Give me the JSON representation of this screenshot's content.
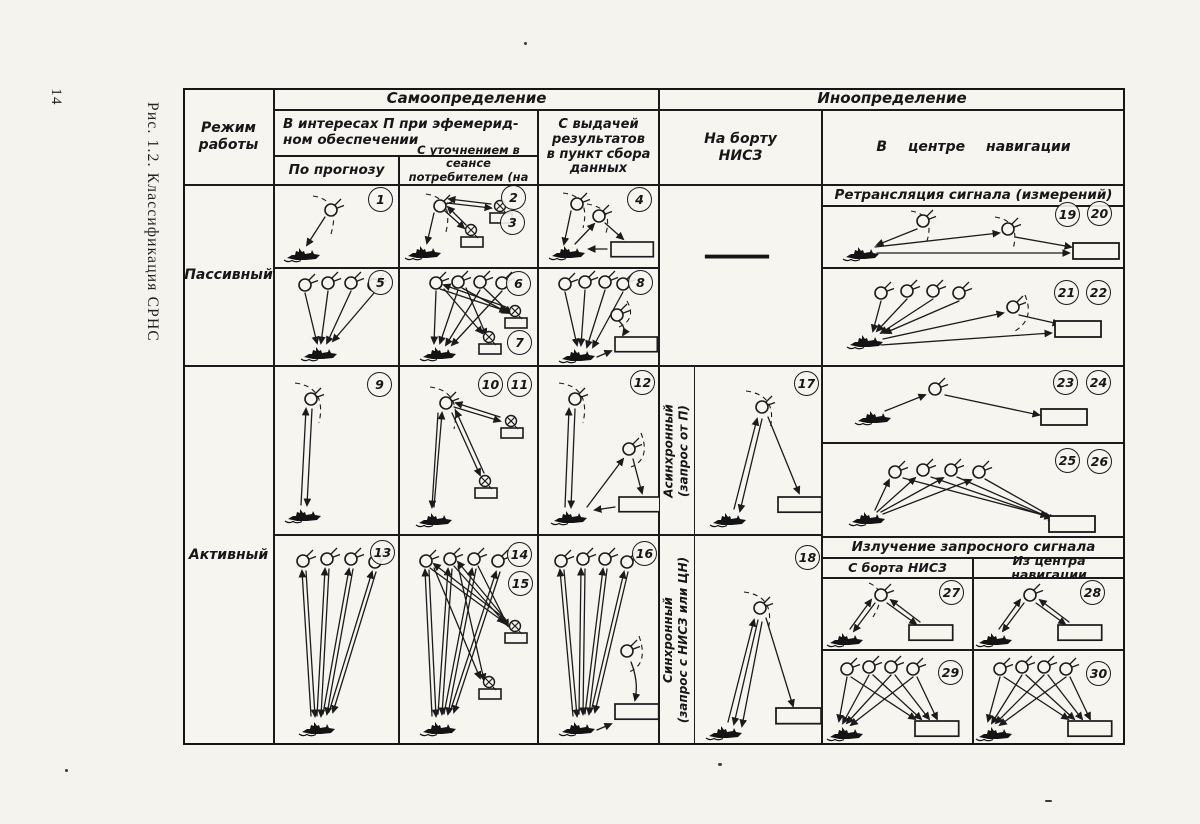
{
  "page": {
    "number": "14",
    "caption": "Рис. 1.2. Классификация СРНС"
  },
  "table": {
    "regime1": "Режим",
    "regime2": "работы",
    "self": "Самоопределение",
    "other": "Иноопределение",
    "interests1": "В интересах П при эфемерид-",
    "interests2": "ном обеспечении",
    "forecast": "По прогнозу",
    "refine1": "С уточнением в сеансе",
    "refine2": "потребителем (на НИСЗ)",
    "results1": "С выдачей",
    "results2": "результатов",
    "results3": "в пункт сбора",
    "results4": "данных",
    "onboard1": "На борту",
    "onboard2": "НИСЗ",
    "center": "В центре  навигации",
    "relay": "Ретрансляция сигнала (измерений)",
    "emission": "Излучение запросного сигнала",
    "from_board": "С борта НИСЗ",
    "from_center": "Из центра навигации",
    "passive": "Пассивный",
    "active": "Активный",
    "async1": "Асинхронный",
    "async2": "(запрос от П)",
    "sync1": "Синхронный",
    "sync2": "(запрос с НИСЗ или ЦН)",
    "dash": "—",
    "badges": {
      "n1": "1",
      "n2": "2",
      "n3": "3",
      "n4": "4",
      "n5": "5",
      "n6": "6",
      "n7": "7",
      "n8": "8",
      "n9": "9",
      "n10": "10",
      "n11": "11",
      "n12": "12",
      "n13": "13",
      "n14": "14",
      "n15": "15",
      "n16": "16",
      "n17": "17",
      "n18": "18",
      "n19": "19",
      "n20": "20",
      "n21": "21",
      "n22": "22",
      "n23": "23",
      "n24": "24",
      "n25": "25",
      "n26": "26",
      "n27": "27",
      "n28": "28",
      "n29": "29",
      "n30": "30"
    }
  },
  "icons": {
    "satellite": "satellite-icon",
    "ship": "ship-icon",
    "ground_station": "ground-station-icon",
    "collection_point": "collection-box-icon"
  },
  "colors": {
    "ink": "#1b1b1b",
    "paper": "#f4f3ee"
  }
}
